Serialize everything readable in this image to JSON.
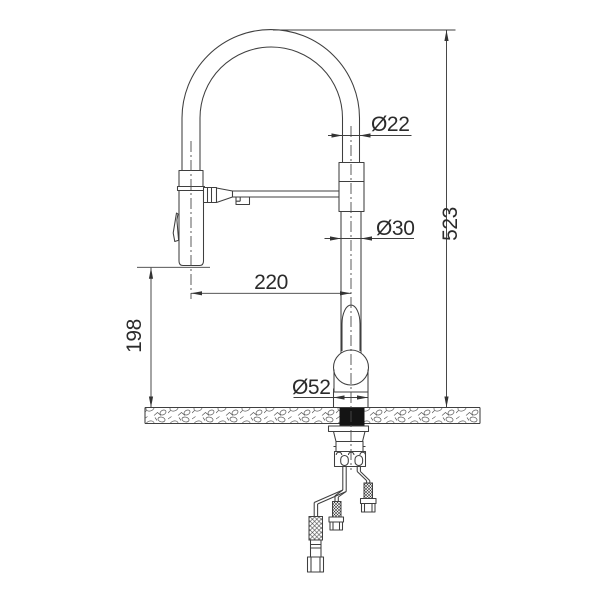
{
  "drawing": {
    "type": "faucet-installation-technical-drawing",
    "colors": {
      "line": "#3f3f3f",
      "text": "#2b2b2b",
      "background": "#ffffff",
      "section_fill": "#141414"
    },
    "dimensions": {
      "hose_tube_diameter": {
        "label": "Ø22"
      },
      "body_tube_diameter": {
        "label": "Ø30"
      },
      "base_diameter": {
        "label": "Ø52"
      },
      "overall_height": {
        "label": "523"
      },
      "spray_outlet_height": {
        "label": "198"
      },
      "spout_reach": {
        "label": "220"
      }
    }
  }
}
